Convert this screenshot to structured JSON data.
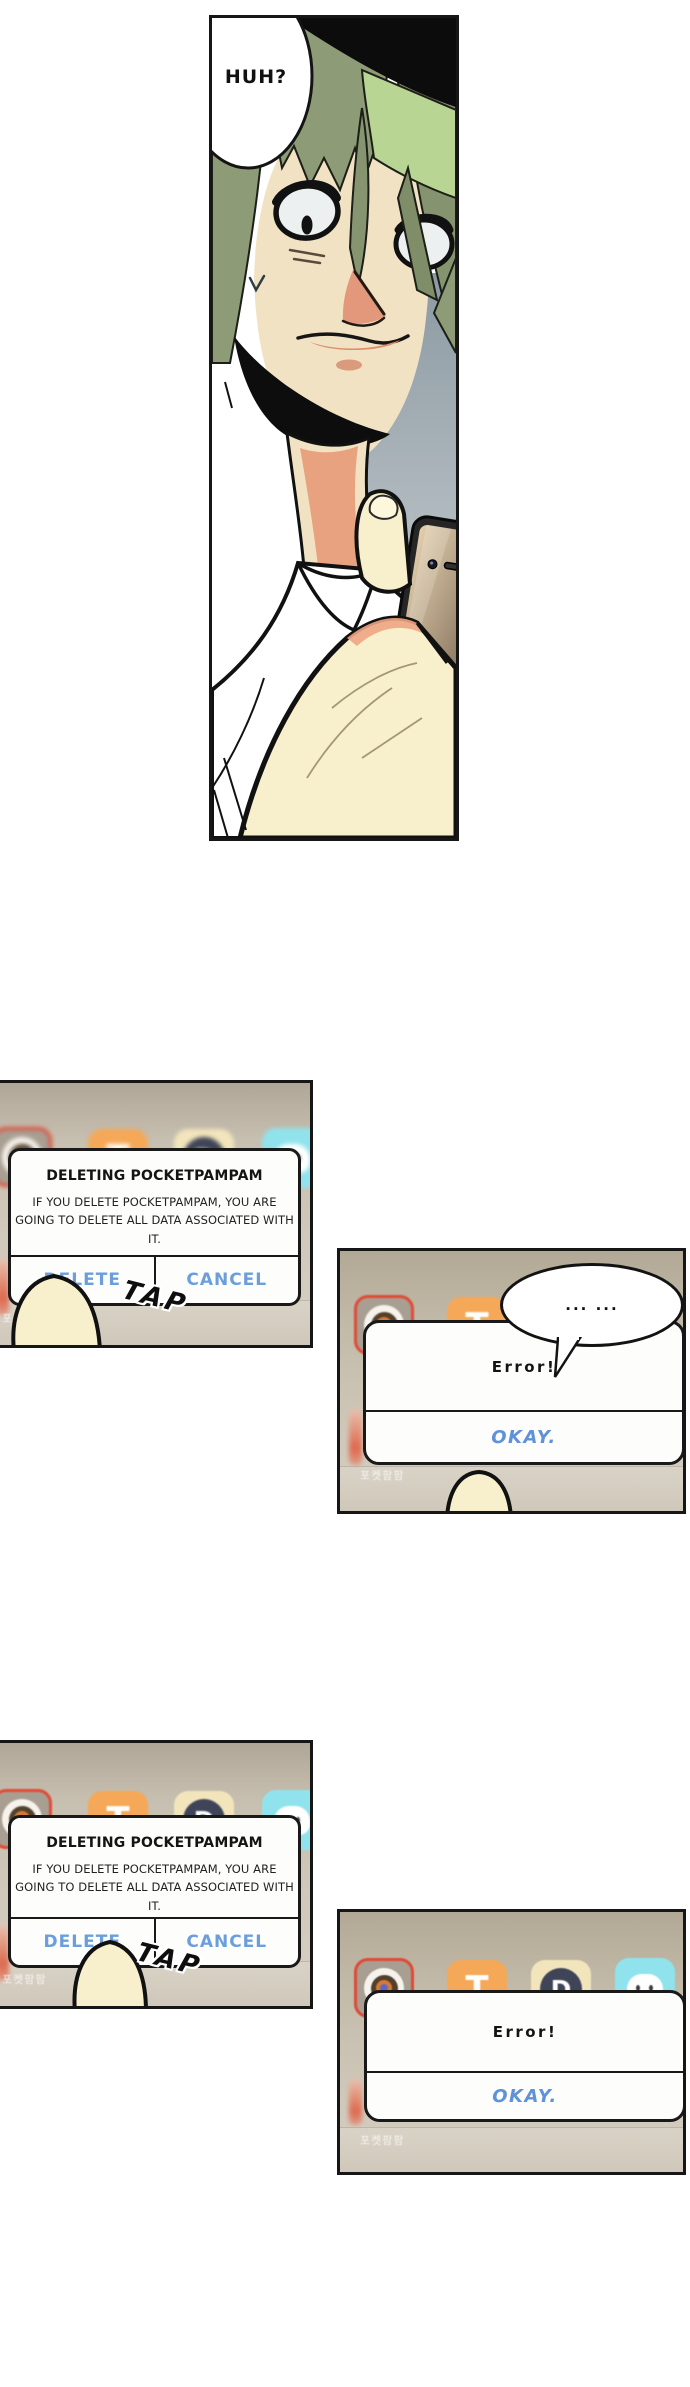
{
  "comic": {
    "speech_huh": "HUH?",
    "tap": "TAP",
    "thought_dots": "... ...",
    "delete_dialog": {
      "title": "DELETING POCKETPAMPAM",
      "line1": "IF YOU DELETE POCKETPAMPAM, YOU ARE",
      "line2": "GOING TO DELETE ALL DATA ASSOCIATED WITH IT.",
      "delete": "DELETE",
      "cancel": "CANCEL"
    },
    "error_dialog": {
      "title": "Error!",
      "okay": "OKAY."
    },
    "apps": {
      "t_letter": "T",
      "d_letter": "D",
      "label_kr": "포켓팜팜"
    },
    "colors": {
      "button_blue": "#6b9edc",
      "okay_blue": "#5f92d8",
      "delete_mode_red": "#e04a36",
      "wallpaper_top": "#b2a896",
      "wallpaper_bottom": "#d6cfc2",
      "hair_green": "#8d9b76",
      "skin": "#f2e2c4"
    }
  }
}
